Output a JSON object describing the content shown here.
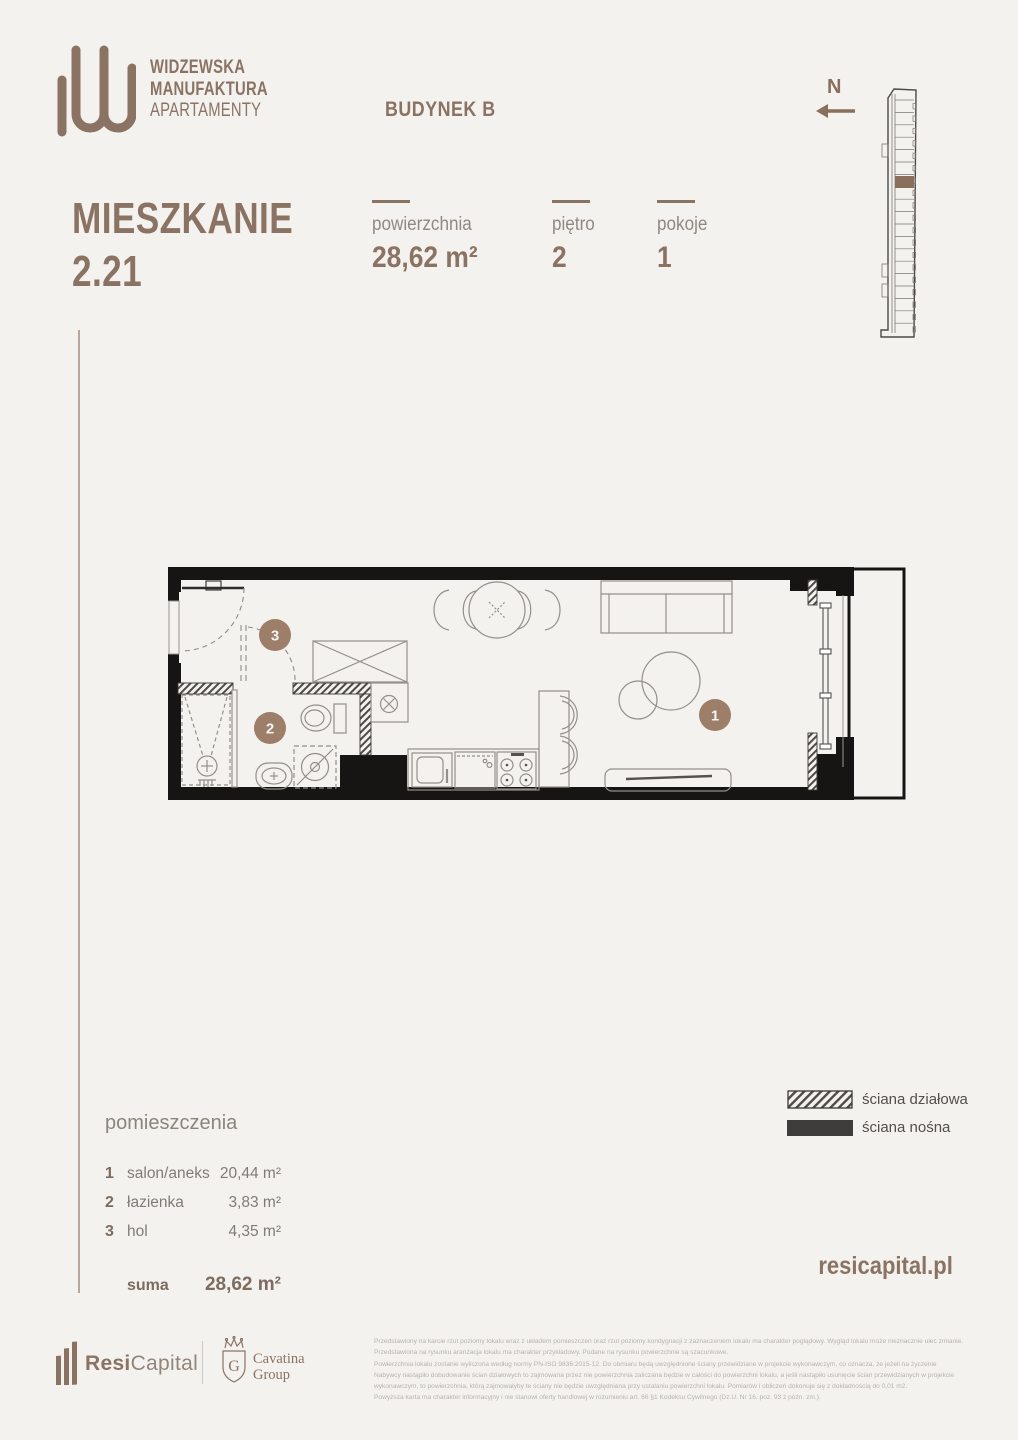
{
  "page": {
    "background": "#f4f2ef",
    "accent_brown": "#8b7363",
    "marker_brown": "#9c7e69",
    "wall_black": "#171513",
    "highlight_unit_brown": "#8a6f5c"
  },
  "header": {
    "logo": {
      "line1": "WIDZEWSKA",
      "line2": "MANUFAKTURA",
      "line3": "APARTAMENTY"
    },
    "building_label": "BUDYNEK B",
    "title_line1": "MIESZKANIE",
    "title_line2": "2.21",
    "stats": [
      {
        "label": "powierzchnia",
        "value": "28,62 m²"
      },
      {
        "label": "piętro",
        "value": "2"
      },
      {
        "label": "pokoje",
        "value": "1"
      }
    ],
    "compass_label": "N"
  },
  "floorplan": {
    "markers": [
      "1",
      "2",
      "3"
    ]
  },
  "legend": {
    "items": [
      {
        "type": "hatched",
        "label": "ściana działowa"
      },
      {
        "type": "solid",
        "label": "ściana nośna"
      }
    ]
  },
  "rooms": {
    "header": "pomieszczenia",
    "items": [
      {
        "num": "1",
        "name": "salon/aneks",
        "area": "20,44 m²"
      },
      {
        "num": "2",
        "name": "łazienka",
        "area": "3,83 m²"
      },
      {
        "num": "3",
        "name": "hol",
        "area": "4,35 m²"
      }
    ],
    "total_label": "suma",
    "total_value": "28,62 m²"
  },
  "footer": {
    "website": "resicapital.pl",
    "brand1": {
      "bold": "Resi",
      "regular": "Capital"
    },
    "brand2": {
      "line1": "Cavatina",
      "line2": "Group",
      "monogram": "G"
    },
    "disclaimer_lines": [
      "Przedstawiony na karcie rzut poziomy lokalu wraz z układem pomieszczeń oraz rzut poziomy kondygnacji z zaznaczeniem lokalu ma charakter poglądowy. Wygląd lokalu może nieznacznie ulec zmianie.",
      "Przedstawiona na rysunku aranżacja lokalu ma charakter przykładowy. Podane na rysunku powierzchnie są szacunkowe.",
      "Powierzchnia lokalu zostanie wyliczona według normy PN-ISO 9836:2015-12. Do obmiaru będą uwzględnione ściany przewidziane w projekcie wykonawczym, co oznacza, że jeżeli na życzenie",
      "Nabywcy nastąpiło dobudowanie ścian działowych to zajmowana przez nie powierzchnia zaliczana będzie w całości do powierzchni lokalu, a jeśli nastąpiło usunięcie ścian przewidzianych w projekcie",
      "wykonawczym, to powierzchnia, którą zajmowałyby te ściany nie będzie uwzględniana przy ustalaniu powierzchni lokalu. Pomiarów i obliczeń dokonuje się z dokładnością do 0,01 m2.",
      "Powyższa karta ma charakter informacyjny i nie stanowi oferty handlowej w rozumieniu art. 66 §1 Kodeksu Cywilnego (Dz.U. Nr 16, poz. 93 z późn. zm.)."
    ]
  }
}
